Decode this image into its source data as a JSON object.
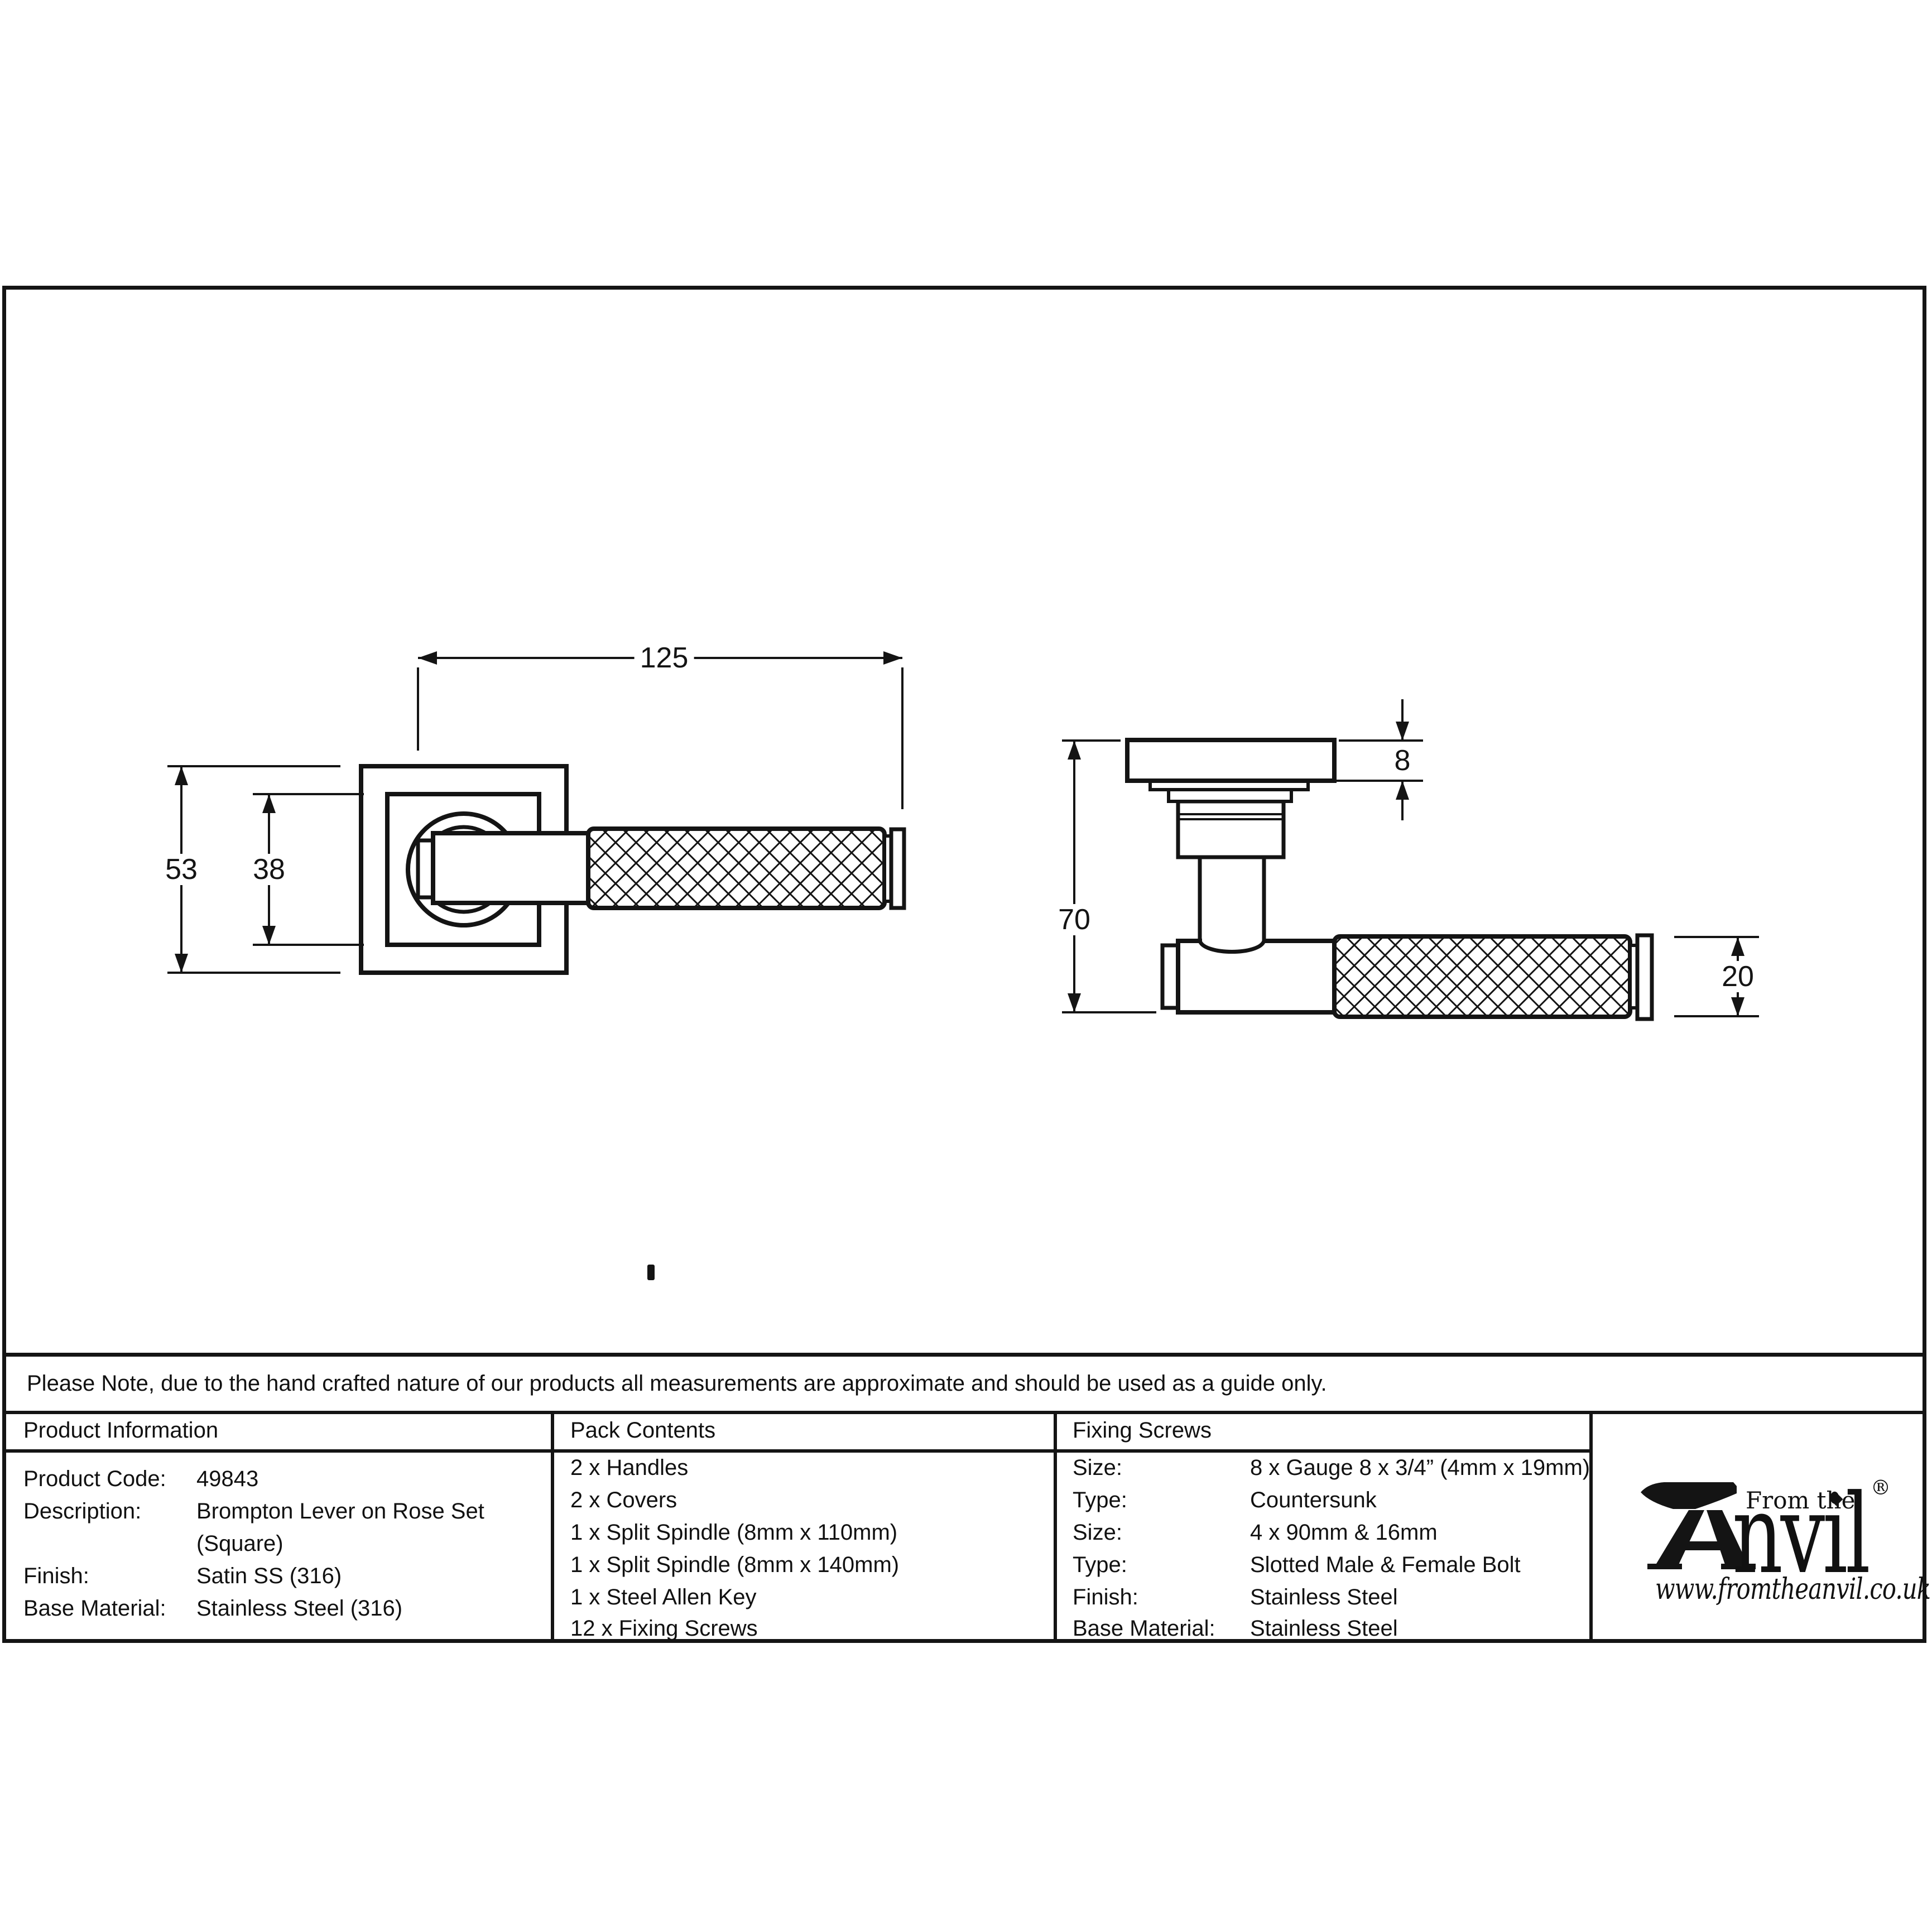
{
  "note": "Please Note, due to the hand crafted nature of our products all measurements are approximate and should be used as a guide only.",
  "drawing": {
    "front_view": "front-view of lever on square rose",
    "side_view": "side-view of lever on rose",
    "dimensions": {
      "lever_length": "125",
      "rose_outer": "53",
      "rose_inner": "38",
      "projection": "70",
      "rose_thickness": "8",
      "lever_diameter": "20"
    }
  },
  "table": {
    "product_information": {
      "header": "Product Information",
      "rows": [
        {
          "label": "Product Code:",
          "value": "49843"
        },
        {
          "label": "Description:",
          "value": "Brompton Lever on Rose Set"
        },
        {
          "label": "",
          "value": "(Square)"
        },
        {
          "label": "Finish:",
          "value": "Satin SS (316)"
        },
        {
          "label": "Base Material:",
          "value": "Stainless Steel (316)"
        }
      ]
    },
    "pack_contents": {
      "header": "Pack Contents",
      "items": [
        "2 x Handles",
        "2 x Covers",
        "1 x Split Spindle (8mm x 110mm)",
        "1 x Split Spindle (8mm x 140mm)",
        "1 x Steel Allen Key",
        "12 x Fixing Screws"
      ]
    },
    "fixing_screws": {
      "header": "Fixing Screws",
      "rows": [
        {
          "label": "Size:",
          "value": "8 x Gauge 8 x 3/4” (4mm x 19mm)"
        },
        {
          "label": "Type:",
          "value": "Countersunk"
        },
        {
          "label": "Size:",
          "value": "4 x 90mm & 16mm"
        },
        {
          "label": "Type:",
          "value": "Slotted Male & Female Bolt"
        },
        {
          "label": "Finish:",
          "value": "Stainless Steel"
        },
        {
          "label": "Base Material:",
          "value": "Stainless Steel"
        }
      ]
    }
  },
  "logo": {
    "prefix": "From the",
    "name_rest": "nvil",
    "registered": "®",
    "website": "www.fromtheanvil.co.uk"
  },
  "colors": {
    "ink": "#141414",
    "paper": "#ffffff"
  }
}
